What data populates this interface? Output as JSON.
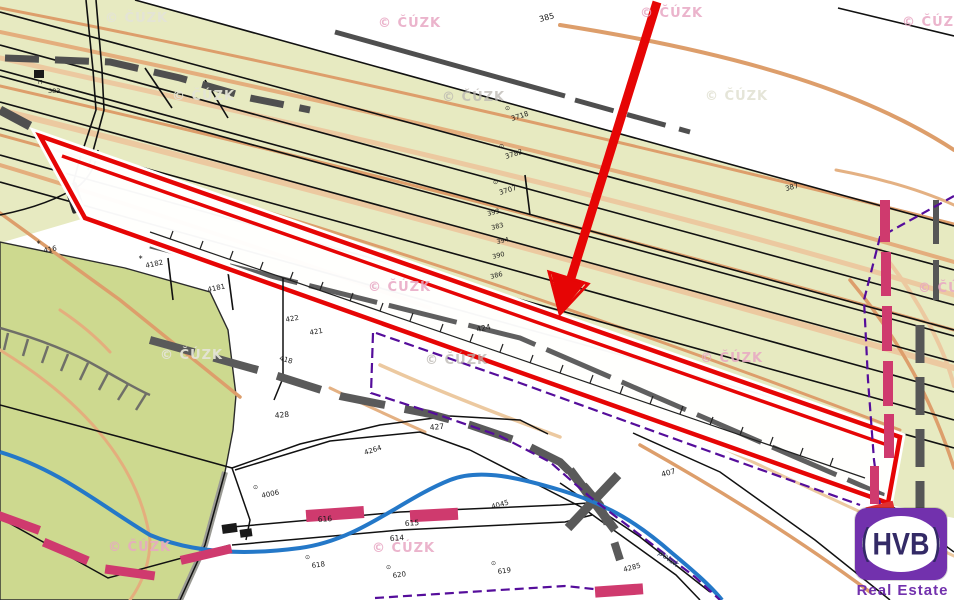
{
  "map": {
    "watermark_text": "© ČÚZK",
    "watermarks": [
      {
        "x": 105,
        "y": 22,
        "tone": "light"
      },
      {
        "x": 378,
        "y": 27,
        "tone": "pink"
      },
      {
        "x": 640,
        "y": 17,
        "tone": "pink"
      },
      {
        "x": 902,
        "y": 26,
        "tone": "pink"
      },
      {
        "x": 172,
        "y": 100,
        "tone": "light"
      },
      {
        "x": 442,
        "y": 101,
        "tone": "gray"
      },
      {
        "x": 705,
        "y": 100,
        "tone": "light"
      },
      {
        "x": 368,
        "y": 291,
        "tone": "pink"
      },
      {
        "x": 918,
        "y": 292,
        "tone": "pink"
      },
      {
        "x": 160,
        "y": 359,
        "tone": "light"
      },
      {
        "x": 425,
        "y": 364,
        "tone": "gray"
      },
      {
        "x": 700,
        "y": 362,
        "tone": "pink"
      },
      {
        "x": 108,
        "y": 551,
        "tone": "pink"
      },
      {
        "x": 372,
        "y": 552,
        "tone": "pink"
      }
    ],
    "parcel_labels": [
      {
        "t": "385",
        "x": 540,
        "y": 22,
        "r": -15,
        "s": 8
      },
      {
        "t": "387",
        "x": 786,
        "y": 191,
        "r": -15,
        "s": 7
      },
      {
        "t": "3718",
        "x": 512,
        "y": 121,
        "r": -18,
        "s": 7
      },
      {
        "t": "3782",
        "x": 506,
        "y": 159,
        "r": -18,
        "s": 7
      },
      {
        "t": "3707",
        "x": 500,
        "y": 195,
        "r": -18,
        "s": 7
      },
      {
        "t": "393",
        "x": 488,
        "y": 216,
        "r": -15,
        "s": 6.5
      },
      {
        "t": "383",
        "x": 492,
        "y": 230,
        "r": -15,
        "s": 6.5
      },
      {
        "t": "394",
        "x": 497,
        "y": 244,
        "r": -12,
        "s": 6.5
      },
      {
        "t": "390",
        "x": 493,
        "y": 259,
        "r": -15,
        "s": 6.5
      },
      {
        "t": "386",
        "x": 491,
        "y": 279,
        "r": -15,
        "s": 6.5
      },
      {
        "t": "383",
        "x": 48,
        "y": 93,
        "r": 0,
        "s": 6.5
      },
      {
        "t": "416",
        "x": 44,
        "y": 253,
        "r": -12,
        "s": 7
      },
      {
        "t": "4182",
        "x": 146,
        "y": 268,
        "r": -12,
        "s": 7
      },
      {
        "t": "4181",
        "x": 208,
        "y": 292,
        "r": -12,
        "s": 7
      },
      {
        "t": "422",
        "x": 286,
        "y": 322,
        "r": -10,
        "s": 7
      },
      {
        "t": "421",
        "x": 310,
        "y": 335,
        "r": -10,
        "s": 7
      },
      {
        "t": "424",
        "x": 477,
        "y": 332,
        "r": -12,
        "s": 7.5
      },
      {
        "t": "418",
        "x": 279,
        "y": 360,
        "r": 16,
        "s": 7
      },
      {
        "t": "428",
        "x": 275,
        "y": 418,
        "r": -5,
        "s": 7.5
      },
      {
        "t": "427",
        "x": 430,
        "y": 430,
        "r": -5,
        "s": 7.5
      },
      {
        "t": "4264",
        "x": 365,
        "y": 455,
        "r": -18,
        "s": 7
      },
      {
        "t": "4006",
        "x": 262,
        "y": 498,
        "r": -12,
        "s": 7
      },
      {
        "t": "616",
        "x": 318,
        "y": 522,
        "r": -4,
        "s": 7.5
      },
      {
        "t": "615",
        "x": 405,
        "y": 526,
        "r": -4,
        "s": 7.5
      },
      {
        "t": "614",
        "x": 390,
        "y": 541,
        "r": -4,
        "s": 7.5
      },
      {
        "t": "618",
        "x": 312,
        "y": 568,
        "r": -8,
        "s": 7
      },
      {
        "t": "620",
        "x": 393,
        "y": 578,
        "r": -8,
        "s": 7
      },
      {
        "t": "619",
        "x": 498,
        "y": 574,
        "r": -8,
        "s": 7
      },
      {
        "t": "4045",
        "x": 492,
        "y": 509,
        "r": -15,
        "s": 7
      },
      {
        "t": "407",
        "x": 662,
        "y": 477,
        "r": -15,
        "s": 7.5
      },
      {
        "t": "4285",
        "x": 624,
        "y": 572,
        "r": -15,
        "s": 7
      },
      {
        "t": "potok",
        "x": 658,
        "y": 554,
        "r": 36,
        "s": 8,
        "style": "italic"
      }
    ],
    "symbols": [
      {
        "t": "⊙",
        "x": 505,
        "y": 110
      },
      {
        "t": "⊙",
        "x": 499,
        "y": 148
      },
      {
        "t": "⊙",
        "x": 493,
        "y": 184
      },
      {
        "t": "∗",
        "x": 36,
        "y": 244
      },
      {
        "t": "∗",
        "x": 138,
        "y": 259
      },
      {
        "t": "⊙",
        "x": 253,
        "y": 489
      },
      {
        "t": "⊙",
        "x": 305,
        "y": 559
      },
      {
        "t": "⊙",
        "x": 386,
        "y": 569
      },
      {
        "t": "⊙",
        "x": 491,
        "y": 565
      },
      {
        "t": "⊓",
        "x": 38,
        "y": 84
      }
    ]
  },
  "logo": {
    "text": "HVB",
    "subtext": "Real Estate",
    "bracket_left": "(",
    "bracket_right": ")"
  },
  "colors": {
    "annotation_red": "#e60505",
    "khaki_area": "#e7eac1",
    "green_area": "#cdd98f",
    "contour_orange": "#dd9e6b",
    "contour_orange_light": "#ecc9a0",
    "stream_blue": "#2478c8",
    "utility_purple": "#550d9b",
    "marker_pink": "#cf3a6e",
    "road_gray": "#5f5f5f",
    "logo_purple": "#7231ad",
    "logo_text": "#332a66"
  }
}
